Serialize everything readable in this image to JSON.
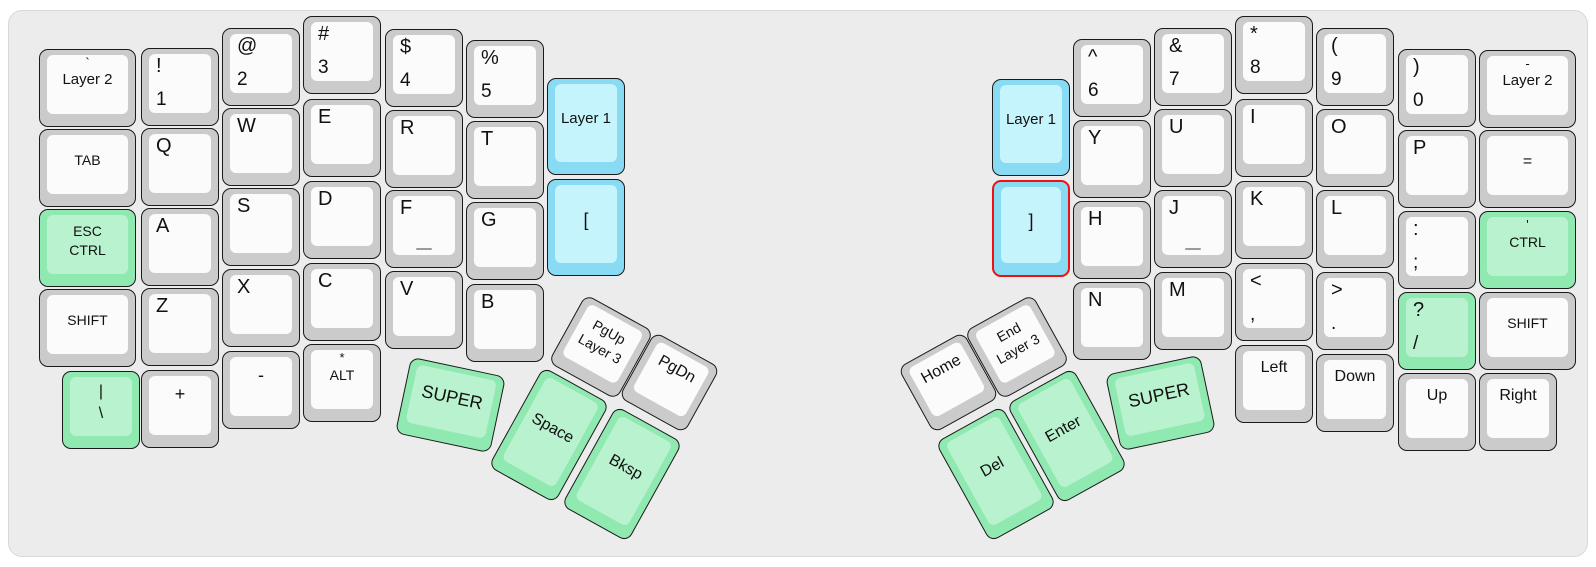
{
  "app": {
    "description": "Split ergonomic keyboard layout (Atreus-style), base layer view",
    "selected_key": "right-bracket"
  },
  "colors": {
    "page": "#ffffff",
    "panel": "#ececec",
    "panel_border": "#d8d8d8",
    "key_border": "#1a1a1a",
    "white_outer": "#cbcbcb",
    "white_inner": "#fbfbfb",
    "green_outer": "#8fe9b1",
    "green_inner": "#b9f2ce",
    "blue_outer": "#88dbf3",
    "blue_inner": "#c5f4fd",
    "selected_border": "#ee1111",
    "text": "#111111",
    "homing": "#9a9a9a"
  },
  "keyboard": {
    "keys": [
      {
        "name": "grave-layer2",
        "x": 39,
        "y": 49,
        "w": 97,
        "labels": {
          "tc": "`",
          "c": "Layer 2"
        }
      },
      {
        "name": "tab",
        "x": 39,
        "y": 129,
        "w": 97,
        "labels": {
          "c": "TAB"
        },
        "fs": 14
      },
      {
        "name": "esc-ctrl",
        "x": 39,
        "y": 209,
        "w": 97,
        "color": "green",
        "labels": {
          "c": "ESC\nCTRL"
        },
        "fs": 14
      },
      {
        "name": "shift-left",
        "x": 39,
        "y": 289,
        "w": 97,
        "labels": {
          "c": "SHIFT"
        },
        "fs": 14
      },
      {
        "name": "pipe-backslash",
        "x": 62,
        "y": 371,
        "color": "green",
        "labels": {
          "c": "|\n\\"
        },
        "fs": 16
      },
      {
        "name": "exclam-1",
        "x": 141,
        "y": 48,
        "labels": {
          "tl": "!",
          "bl": "1"
        }
      },
      {
        "name": "q",
        "x": 141,
        "y": 128,
        "labels": {
          "tl": "Q"
        }
      },
      {
        "name": "a",
        "x": 141,
        "y": 208,
        "labels": {
          "tl": "A"
        }
      },
      {
        "name": "z",
        "x": 141,
        "y": 288,
        "labels": {
          "tl": "Z"
        }
      },
      {
        "name": "plus",
        "x": 141,
        "y": 370,
        "labels": {
          "ct": "+"
        },
        "fs": 18
      },
      {
        "name": "at-2",
        "x": 222,
        "y": 28,
        "labels": {
          "tl": "@",
          "bl": "2"
        }
      },
      {
        "name": "w",
        "x": 222,
        "y": 108,
        "labels": {
          "tl": "W"
        }
      },
      {
        "name": "s",
        "x": 222,
        "y": 188,
        "labels": {
          "tl": "S"
        }
      },
      {
        "name": "x",
        "x": 222,
        "y": 269,
        "labels": {
          "tl": "X"
        }
      },
      {
        "name": "minus",
        "x": 222,
        "y": 351,
        "labels": {
          "ct": "-"
        },
        "fs": 18
      },
      {
        "name": "hash-3",
        "x": 303,
        "y": 16,
        "labels": {
          "tl": "#",
          "bl": "3"
        }
      },
      {
        "name": "e",
        "x": 303,
        "y": 99,
        "labels": {
          "tl": "E"
        }
      },
      {
        "name": "d",
        "x": 303,
        "y": 181,
        "labels": {
          "tl": "D"
        }
      },
      {
        "name": "c",
        "x": 303,
        "y": 263,
        "labels": {
          "tl": "C"
        }
      },
      {
        "name": "star-alt",
        "x": 303,
        "y": 344,
        "labels": {
          "tc": "*",
          "c": "ALT"
        },
        "fs": 14
      },
      {
        "name": "dollar-4",
        "x": 385,
        "y": 29,
        "labels": {
          "tl": "$",
          "bl": "4"
        }
      },
      {
        "name": "r",
        "x": 385,
        "y": 110,
        "labels": {
          "tl": "R"
        }
      },
      {
        "name": "f",
        "x": 385,
        "y": 190,
        "labels": {
          "tl": "F"
        },
        "homing": true
      },
      {
        "name": "v",
        "x": 385,
        "y": 271,
        "labels": {
          "tl": "V"
        }
      },
      {
        "name": "percent-5",
        "x": 466,
        "y": 40,
        "labels": {
          "tl": "%",
          "bl": "5"
        }
      },
      {
        "name": "t",
        "x": 466,
        "y": 121,
        "labels": {
          "tl": "T"
        }
      },
      {
        "name": "g",
        "x": 466,
        "y": 202,
        "labels": {
          "tl": "G"
        }
      },
      {
        "name": "b",
        "x": 466,
        "y": 284,
        "labels": {
          "tl": "B"
        }
      },
      {
        "name": "layer1-left",
        "x": 547,
        "y": 78,
        "h": 97,
        "color": "blue",
        "labels": {
          "c": "Layer 1"
        }
      },
      {
        "name": "left-bracket",
        "x": 547,
        "y": 179,
        "h": 97,
        "color": "blue",
        "labels": {
          "c": "["
        },
        "fs": 18
      },
      {
        "name": "layer1-right",
        "x": 992,
        "y": 79,
        "h": 97,
        "color": "blue",
        "labels": {
          "c": "Layer 1"
        }
      },
      {
        "name": "right-bracket",
        "x": 992,
        "y": 180,
        "h": 97,
        "color": "blue",
        "selected": true,
        "labels": {
          "c": "]"
        },
        "fs": 18
      },
      {
        "name": "caret-6",
        "x": 1073,
        "y": 39,
        "labels": {
          "tl": "^",
          "bl": "6"
        }
      },
      {
        "name": "y",
        "x": 1073,
        "y": 120,
        "labels": {
          "tl": "Y"
        }
      },
      {
        "name": "h",
        "x": 1073,
        "y": 201,
        "labels": {
          "tl": "H"
        }
      },
      {
        "name": "n",
        "x": 1073,
        "y": 282,
        "labels": {
          "tl": "N"
        }
      },
      {
        "name": "amp-7",
        "x": 1154,
        "y": 28,
        "labels": {
          "tl": "&",
          "bl": "7"
        }
      },
      {
        "name": "u",
        "x": 1154,
        "y": 109,
        "labels": {
          "tl": "U"
        }
      },
      {
        "name": "j",
        "x": 1154,
        "y": 190,
        "labels": {
          "tl": "J"
        },
        "homing": true
      },
      {
        "name": "m",
        "x": 1154,
        "y": 272,
        "labels": {
          "tl": "M"
        }
      },
      {
        "name": "star-8",
        "x": 1235,
        "y": 16,
        "labels": {
          "tl": "*",
          "bl": "8"
        }
      },
      {
        "name": "i",
        "x": 1235,
        "y": 99,
        "labels": {
          "tl": "I"
        }
      },
      {
        "name": "k",
        "x": 1235,
        "y": 181,
        "labels": {
          "tl": "K"
        }
      },
      {
        "name": "lt-comma",
        "x": 1235,
        "y": 263,
        "labels": {
          "tl": "<",
          "bl": ","
        }
      },
      {
        "name": "left-arrow",
        "x": 1235,
        "y": 345,
        "labels": {
          "ct": "Left"
        }
      },
      {
        "name": "lparen-9",
        "x": 1316,
        "y": 28,
        "labels": {
          "tl": "(",
          "bl": "9"
        }
      },
      {
        "name": "o",
        "x": 1316,
        "y": 109,
        "labels": {
          "tl": "O"
        }
      },
      {
        "name": "l",
        "x": 1316,
        "y": 190,
        "labels": {
          "tl": "L"
        }
      },
      {
        "name": "gt-period",
        "x": 1316,
        "y": 272,
        "labels": {
          "tl": ">",
          "bl": "."
        }
      },
      {
        "name": "down-arrow",
        "x": 1316,
        "y": 354,
        "labels": {
          "ct": "Down"
        }
      },
      {
        "name": "rparen-0",
        "x": 1398,
        "y": 49,
        "labels": {
          "tl": ")",
          "bl": "0"
        }
      },
      {
        "name": "p",
        "x": 1398,
        "y": 130,
        "labels": {
          "tl": "P"
        }
      },
      {
        "name": "colon-semicolon",
        "x": 1398,
        "y": 211,
        "labels": {
          "tl": ":",
          "bl": ";"
        }
      },
      {
        "name": "question-slash",
        "x": 1398,
        "y": 292,
        "color": "green",
        "labels": {
          "tl": "?",
          "bl": "/"
        }
      },
      {
        "name": "up-arrow",
        "x": 1398,
        "y": 373,
        "labels": {
          "ct": "Up"
        }
      },
      {
        "name": "minus-layer2",
        "x": 1479,
        "y": 50,
        "w": 97,
        "labels": {
          "tc": "-",
          "c": "Layer 2"
        }
      },
      {
        "name": "equals",
        "x": 1479,
        "y": 130,
        "w": 97,
        "labels": {
          "c": "="
        },
        "fs": 16
      },
      {
        "name": "quote-ctrl",
        "x": 1479,
        "y": 211,
        "w": 97,
        "color": "green",
        "labels": {
          "tc": "'",
          "c": "CTRL"
        },
        "fs": 14
      },
      {
        "name": "shift-right",
        "x": 1479,
        "y": 292,
        "w": 97,
        "labels": {
          "c": "SHIFT"
        },
        "fs": 14
      },
      {
        "name": "right-arrow",
        "x": 1479,
        "y": 373,
        "labels": {
          "ct": "Right"
        }
      },
      {
        "name": "space",
        "x": 511,
        "y": 378,
        "w": 76,
        "h": 114,
        "rot": 29,
        "color": "green",
        "labels": {
          "c": "Space"
        },
        "fs": 16
      },
      {
        "name": "bksp",
        "x": 584,
        "y": 417,
        "w": 76,
        "h": 114,
        "rot": 29,
        "color": "green",
        "labels": {
          "c": "Bksp"
        },
        "fs": 16
      },
      {
        "name": "del",
        "x": 958,
        "y": 417,
        "w": 76,
        "h": 114,
        "rot": -29,
        "color": "green",
        "labels": {
          "c": "Del"
        },
        "fs": 16
      },
      {
        "name": "enter",
        "x": 1029,
        "y": 379,
        "w": 76,
        "h": 114,
        "rot": -29,
        "color": "green",
        "labels": {
          "c": "Enter"
        },
        "fs": 16
      },
      {
        "name": "pgup-layer3",
        "x": 562,
        "y": 308,
        "rot": 29,
        "labels": {
          "c": "PgUp\nLayer 3"
        },
        "fs": 14
      },
      {
        "name": "pgdn",
        "x": 632,
        "y": 345,
        "w": 75,
        "h": 75,
        "rot": 29,
        "labels": {
          "ct": "PgDn"
        }
      },
      {
        "name": "home",
        "x": 911,
        "y": 345,
        "w": 75,
        "h": 75,
        "rot": -29,
        "labels": {
          "ct": "Home"
        }
      },
      {
        "name": "end-layer3",
        "x": 978,
        "y": 308,
        "rot": -29,
        "labels": {
          "c": "End\nLayer 3"
        },
        "fs": 14
      },
      {
        "name": "super-left",
        "x": 402,
        "y": 366,
        "w": 97,
        "rot": 12,
        "color": "green",
        "labels": {
          "c": "SUPER"
        },
        "fs": 18
      },
      {
        "name": "super-right",
        "x": 1112,
        "y": 364,
        "w": 97,
        "rot": -12,
        "color": "green",
        "labels": {
          "c": "SUPER"
        },
        "fs": 18
      }
    ]
  }
}
